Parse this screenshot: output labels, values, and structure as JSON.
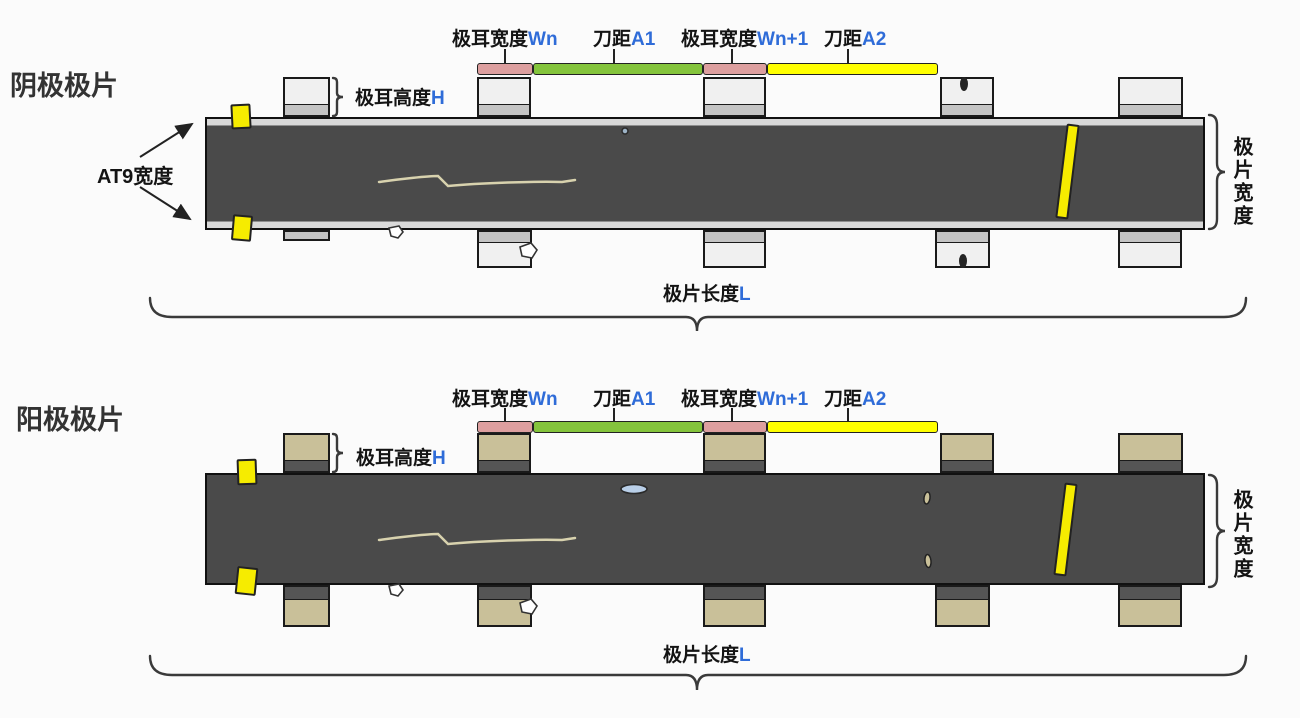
{
  "colors": {
    "background": "#fbfbfb",
    "strip": "#4a4a4a",
    "cathode_tab": "#f0f0f0",
    "cathode_tab_band": "#c4c4c4",
    "anode_tab": "#c9c099",
    "anode_tab_band": "#555555",
    "bar_pink": "#dd9f9f",
    "bar_green": "#84c43c",
    "bar_yellow": "#ffff00",
    "marker_yellow": "#f6ec00",
    "variable_text": "#2f6cd8",
    "ellipse_blue": "#b9cfe8",
    "scratch": "#d8d2ae"
  },
  "cathode": {
    "title": "阴极极片",
    "labels": {
      "tab_width_prefix": "极耳宽度",
      "tab_width_var": "Wn",
      "knife1_prefix": "刀距",
      "knife1_var": "A1",
      "tab_width_next_prefix": "极耳宽度",
      "tab_width_next_var": "Wn+1",
      "knife2_prefix": "刀距",
      "knife2_var": "A2",
      "tab_height_prefix": "极耳高度",
      "tab_height_var": "H",
      "at9_width": "AT9宽度",
      "sheet_width_vertical": "极片宽度",
      "sheet_length_prefix": "极片长度",
      "sheet_length_var": "L"
    }
  },
  "anode": {
    "title": "阳极极片",
    "labels": {
      "tab_width_prefix": "极耳宽度",
      "tab_width_var": "Wn",
      "knife1_prefix": "刀距",
      "knife1_var": "A1",
      "tab_width_next_prefix": "极耳宽度",
      "tab_width_next_var": "Wn+1",
      "knife2_prefix": "刀距",
      "knife2_var": "A2",
      "tab_height_prefix": "极耳高度",
      "tab_height_var": "H",
      "sheet_width_vertical": "极片宽度",
      "sheet_length_prefix": "极片长度",
      "sheet_length_var": "L"
    }
  }
}
